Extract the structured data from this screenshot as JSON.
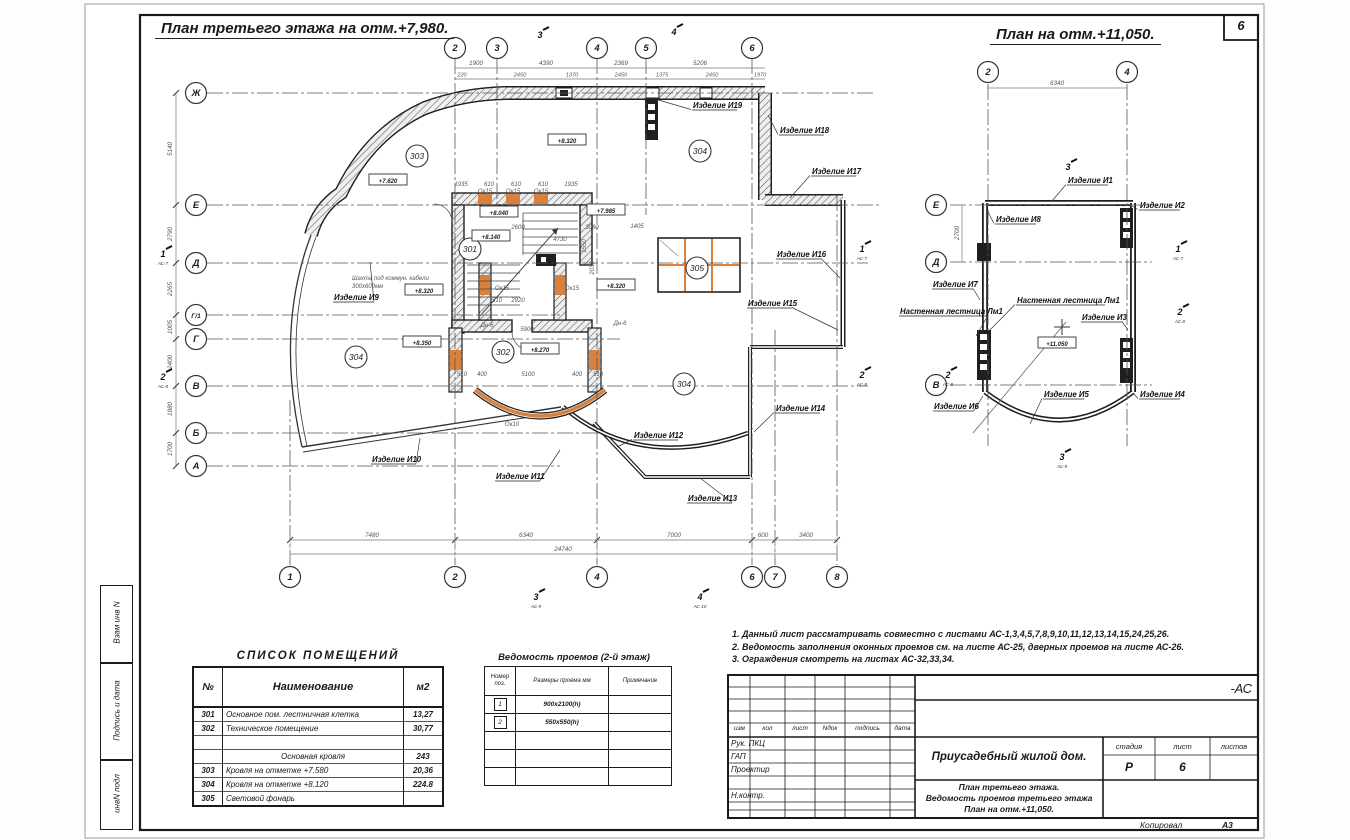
{
  "page": {
    "sheet_number": "6",
    "format_label": "А3",
    "copied_label": "Копировал"
  },
  "titles": {
    "left": "План третьего этажа на отм.+7,980.",
    "right": "План на отм.+11,050."
  },
  "stamp_column": {
    "cells": [
      "Взам инв N",
      "Подпись и дата",
      "инвN подл"
    ]
  },
  "notes": {
    "lines": [
      "1. Данный лист рассматривать совместно с листами АС-1,3,4,5,7,8,9,10,11,12,13,14,15,24,25,26.",
      "2. Ведомость заполнения оконных проемов см. на листе АС-25, дверных проемов на листе АС-26.",
      "3. Ограждения смотреть на листах АС-32,33,34."
    ]
  },
  "rooms_table": {
    "title": "СПИСОК ПОМЕЩЕНИЙ",
    "headers": [
      "№",
      "Наименование",
      "м2"
    ],
    "rows": [
      [
        "301",
        "Основное пом. лестничная клетка",
        "13,27"
      ],
      [
        "302",
        "Техническое помещение",
        "30,77"
      ],
      [
        "",
        "",
        ""
      ],
      [
        "",
        "Основная кровля",
        "243"
      ],
      [
        "303",
        "Кровля на отметке +7.580",
        "20,36"
      ],
      [
        "304",
        "Кровля на отметке +8.120",
        "224.8"
      ],
      [
        "305",
        "Световой фонарь",
        ""
      ]
    ]
  },
  "openings_table": {
    "title": "Ведомость проемов (2-й этаж)",
    "headers": [
      "Номер поз.",
      "Размеры проема мм",
      "Примечание"
    ],
    "rows": [
      [
        "1",
        "900х2100(h)",
        ""
      ],
      [
        "2",
        "550х550(h)",
        ""
      ],
      [
        "",
        "",
        ""
      ],
      [
        "",
        "",
        ""
      ],
      [
        "",
        "",
        ""
      ]
    ]
  },
  "title_block": {
    "code": "-АС",
    "header_cols": [
      "изм",
      "кол",
      "лист",
      "Nдок",
      "подпись",
      "дата"
    ],
    "roles": [
      "Рук. ПКЦ",
      "ГАП",
      "Проектир",
      "",
      "Н.контр."
    ],
    "project": "Приусадебный жилой дом.",
    "sheet_title": [
      "План третьего этажа.",
      "Ведомость проемов третьего этажа",
      "План на отм.+11,050."
    ],
    "stage_label": "стадия",
    "sheet_label": "лист",
    "sheets_label": "листов",
    "stage": "Р",
    "sheet": "6",
    "sheets": ""
  },
  "colors": {
    "window_orange": "#d9813c",
    "wall_dark": "#1f1f1f",
    "dim_gray": "#6b6b6b"
  },
  "main_plan": {
    "v_axes": [
      {
        "l": "1",
        "x": 290,
        "b": 1,
        "y1": 400
      },
      {
        "l": "2",
        "x": 455,
        "t": 1,
        "b": 1
      },
      {
        "l": "3",
        "x": 497,
        "t": 1,
        "y2": 215
      },
      {
        "l": "4",
        "x": 597,
        "t": 1,
        "b": 1
      },
      {
        "l": "5",
        "x": 646,
        "t": 1,
        "y2": 215
      },
      {
        "l": "6",
        "x": 752,
        "t": 1,
        "b": 1
      },
      {
        "l": "7",
        "x": 775,
        "b": 1,
        "y1": 330
      },
      {
        "l": "8",
        "x": 837,
        "b": 1,
        "y1": 195
      }
    ],
    "h_axes": [
      {
        "l": "Ж",
        "y": 93,
        "x2": 875
      },
      {
        "l": "Е",
        "y": 205,
        "x2": 880
      },
      {
        "l": "Д",
        "y": 263,
        "x2": 868
      },
      {
        "l": "Г/1",
        "y": 315,
        "x2": 560
      },
      {
        "l": "Г",
        "y": 339,
        "x2": 620
      },
      {
        "l": "В",
        "y": 386,
        "x2": 868
      },
      {
        "l": "Б",
        "y": 433,
        "x2": 600
      },
      {
        "l": "А",
        "y": 466,
        "x2": 560
      }
    ],
    "left_dims": [
      {
        "v": "5140",
        "y": 149
      },
      {
        "v": "2790",
        "y": 234
      },
      {
        "v": "2265",
        "y": 289
      },
      {
        "v": "1005",
        "y": 327
      },
      {
        "v": "2400",
        "y": 362
      },
      {
        "v": "1880",
        "y": 409
      },
      {
        "v": "1700",
        "y": 449
      }
    ],
    "bottom_dims": [
      {
        "v": "7480",
        "x": 372
      },
      {
        "v": "6340",
        "x": 526
      },
      {
        "v": "7000",
        "x": 674
      },
      {
        "v": "600",
        "x": 763
      },
      {
        "v": "3400",
        "x": 806
      }
    ],
    "bottom_total": {
      "v": "24740",
      "x": 563
    },
    "top_dims_r1": [
      {
        "v": "1900",
        "x": 476
      },
      {
        "v": "4390",
        "x": 546
      },
      {
        "v": "2369",
        "x": 621
      },
      {
        "v": "5206",
        "x": 700
      }
    ],
    "top_dims_r2": [
      {
        "v": "220",
        "x": 462
      },
      {
        "v": "2450",
        "x": 520
      },
      {
        "v": "1370",
        "x": 572
      },
      {
        "v": "2450",
        "x": 621
      },
      {
        "v": "1375",
        "x": 662
      },
      {
        "v": "2450",
        "x": 712
      },
      {
        "v": "1970",
        "x": 760
      }
    ],
    "rooms": [
      {
        "n": "303",
        "x": 417,
        "y": 156
      },
      {
        "n": "301",
        "x": 470,
        "y": 249
      },
      {
        "n": "304",
        "x": 700,
        "y": 151
      },
      {
        "n": "305",
        "x": 697,
        "y": 268
      },
      {
        "n": "304",
        "x": 356,
        "y": 357
      },
      {
        "n": "302",
        "x": 503,
        "y": 352
      },
      {
        "n": "304",
        "x": 684,
        "y": 384
      }
    ],
    "elevations": [
      {
        "v": "+7.620",
        "x": 388,
        "y": 183
      },
      {
        "v": "+8.320",
        "x": 567,
        "y": 143
      },
      {
        "v": "+8.040",
        "x": 499,
        "y": 215
      },
      {
        "v": "+8.140",
        "x": 491,
        "y": 239
      },
      {
        "v": "+7.985",
        "x": 606,
        "y": 213
      },
      {
        "v": "+8.320",
        "x": 424,
        "y": 293
      },
      {
        "v": "+8.320",
        "x": 616,
        "y": 288
      },
      {
        "v": "+8.350",
        "x": 422,
        "y": 345
      },
      {
        "v": "+8.270",
        "x": 540,
        "y": 352
      }
    ],
    "products": [
      {
        "t": "Изделие И19",
        "x": 693,
        "y": 108,
        "tx": 655,
        "ty": 99
      },
      {
        "t": "Изделие И18",
        "x": 780,
        "y": 133,
        "tx": 768,
        "ty": 115
      },
      {
        "t": "Изделие И17",
        "x": 812,
        "y": 174,
        "tx": 790,
        "ty": 198
      },
      {
        "t": "Изделие И16",
        "x": 777,
        "y": 257,
        "tx": 840,
        "ty": 278
      },
      {
        "t": "Изделие И15",
        "x": 748,
        "y": 306,
        "tx": 838,
        "ty": 330
      },
      {
        "t": "Изделие И14",
        "x": 776,
        "y": 411,
        "tx": 754,
        "ty": 432
      },
      {
        "t": "Изделие И13",
        "x": 688,
        "y": 501,
        "tx": 700,
        "ty": 478
      },
      {
        "t": "Изделие И12",
        "x": 634,
        "y": 438,
        "tx": 617,
        "ty": 447
      },
      {
        "t": "Изделие И11",
        "x": 496,
        "y": 479,
        "tx": 560,
        "ty": 450
      },
      {
        "t": "Изделие И10",
        "x": 372,
        "y": 462,
        "tx": 420,
        "ty": 438
      },
      {
        "t": "Изделие И9",
        "x": 334,
        "y": 300,
        "tx": 370,
        "ty": 262
      }
    ],
    "small_texts": [
      {
        "v": "1935",
        "x": 461,
        "y": 186
      },
      {
        "v": "610",
        "x": 489,
        "y": 186
      },
      {
        "v": "610",
        "x": 516,
        "y": 186
      },
      {
        "v": "610",
        "x": 543,
        "y": 186
      },
      {
        "v": "1935",
        "x": 571,
        "y": 186
      },
      {
        "v": "Ок15",
        "x": 485,
        "y": 193
      },
      {
        "v": "Ок15",
        "x": 513,
        "y": 193
      },
      {
        "v": "Ок15",
        "x": 541,
        "y": 193
      },
      {
        "v": "Ок15",
        "x": 502,
        "y": 290
      },
      {
        "v": "Ок15",
        "x": 572,
        "y": 290
      },
      {
        "v": "510",
        "x": 497,
        "y": 302
      },
      {
        "v": "2920",
        "x": 518,
        "y": 302
      },
      {
        "v": "5900",
        "x": 527,
        "y": 331
      },
      {
        "v": "Дн-6",
        "x": 620,
        "y": 325
      },
      {
        "v": "Дн-6",
        "x": 487,
        "y": 327
      },
      {
        "v": "510",
        "x": 462,
        "y": 376
      },
      {
        "v": "400",
        "x": 482,
        "y": 376
      },
      {
        "v": "5100",
        "x": 528,
        "y": 376
      },
      {
        "v": "400",
        "x": 577,
        "y": 376
      },
      {
        "v": "510",
        "x": 598,
        "y": 376
      },
      {
        "v": "Ок10",
        "x": 512,
        "y": 426
      },
      {
        "v": "2600",
        "x": 518,
        "y": 229
      },
      {
        "v": "4730",
        "x": 560,
        "y": 241
      },
      {
        "v": "3080",
        "x": 592,
        "y": 229
      },
      {
        "v": "1405",
        "x": 637,
        "y": 228
      },
      {
        "v": "2030",
        "x": 594,
        "y": 268,
        "r": 1
      },
      {
        "v": "1550",
        "x": 586,
        "y": 246,
        "r": 1
      },
      {
        "v": "Шахта под коммун. кабели",
        "x": 352,
        "y": 280,
        "a": "start"
      },
      {
        "v": "300х600мм",
        "x": 352,
        "y": 288,
        "a": "start"
      }
    ],
    "sections": [
      {
        "n": "1",
        "x": 163,
        "y": 257,
        "sub": "АС-7"
      },
      {
        "n": "2",
        "x": 163,
        "y": 380,
        "sub": "АС-8"
      },
      {
        "n": "1",
        "x": 862,
        "y": 252,
        "sub": "АС-7"
      },
      {
        "n": "2",
        "x": 862,
        "y": 378,
        "sub": "АС-8"
      },
      {
        "n": "3",
        "x": 540,
        "y": 38,
        "sub": ""
      },
      {
        "n": "4",
        "x": 674,
        "y": 35,
        "sub": ""
      },
      {
        "n": "3",
        "x": 536,
        "y": 600,
        "sub": "АС-9"
      },
      {
        "n": "4",
        "x": 700,
        "y": 600,
        "sub": "АС-10"
      }
    ]
  },
  "upper_plan": {
    "v_axes": [
      {
        "l": "2",
        "x": 988
      },
      {
        "l": "4",
        "x": 1127
      }
    ],
    "h_axes": [
      {
        "l": "Е",
        "y": 205
      },
      {
        "l": "Д",
        "y": 262
      },
      {
        "l": "В",
        "y": 385
      }
    ],
    "top_dim": {
      "v": "6340",
      "x": 1057
    },
    "left_dim": {
      "v": "2700",
      "x": 962,
      "y": 233
    },
    "elevation": {
      "v": "+11.050",
      "x": 1057,
      "y": 346
    },
    "products": [
      {
        "t": "Изделие И1",
        "x": 1068,
        "y": 183,
        "tx": 1052,
        "ty": 201
      },
      {
        "t": "Изделие И2",
        "x": 1140,
        "y": 208,
        "tx": 1132,
        "ty": 206
      },
      {
        "t": "Изделие И8",
        "x": 996,
        "y": 222,
        "tx": 987,
        "ty": 210
      },
      {
        "t": "Изделие И7",
        "x": 933,
        "y": 287,
        "tx": 980,
        "ty": 300
      },
      {
        "t": "Изделие И3",
        "x": 1082,
        "y": 320,
        "tx": 1128,
        "ty": 330
      },
      {
        "t": "Изделие И6",
        "x": 934,
        "y": 409,
        "tx": 983,
        "ty": 396
      },
      {
        "t": "Изделие И5",
        "x": 1044,
        "y": 397,
        "tx": 1030,
        "ty": 424
      },
      {
        "t": "Изделие И4",
        "x": 1140,
        "y": 397,
        "tx": 1133,
        "ty": 393
      },
      {
        "t": "Настенная лестница Лм1",
        "x": 900,
        "y": 314,
        "tx": 976,
        "ty": 336
      },
      {
        "t": "Настенная лестница Лм1",
        "x": 1017,
        "y": 303,
        "tx": 990,
        "ty": 330
      }
    ],
    "sections": [
      {
        "n": "1",
        "x": 1178,
        "y": 252,
        "sub": "АС-7"
      },
      {
        "n": "2",
        "x": 948,
        "y": 378,
        "sub": "АС-8"
      },
      {
        "n": "2",
        "x": 1180,
        "y": 315,
        "sub": "АС-8"
      },
      {
        "n": "3",
        "x": 1068,
        "y": 170,
        "sub": ""
      },
      {
        "n": "3",
        "x": 1062,
        "y": 460,
        "sub": "АС-9"
      }
    ]
  }
}
